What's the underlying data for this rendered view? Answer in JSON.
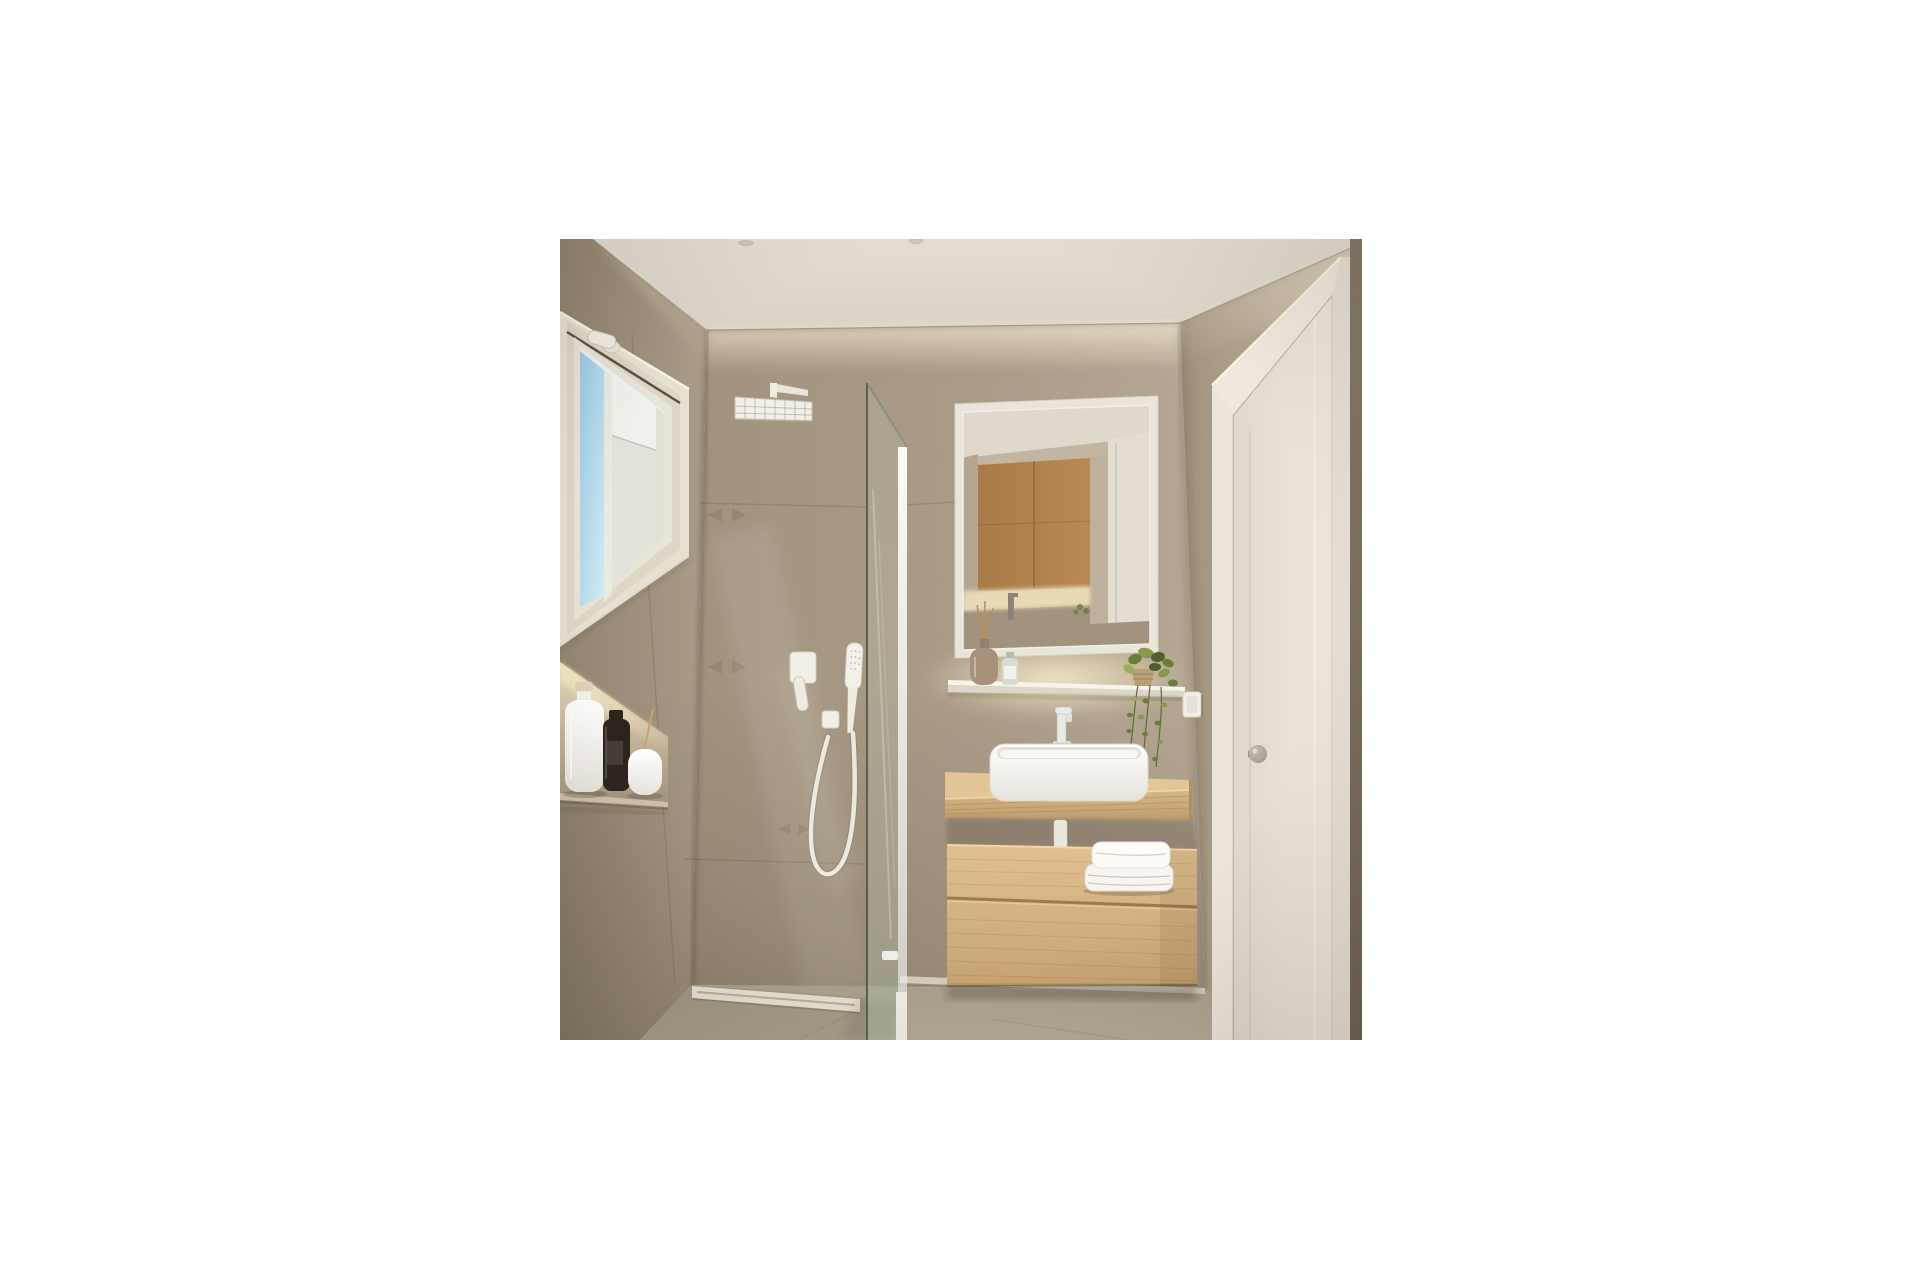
{
  "meta": {
    "description": "3D architectural render of a small modern bathroom with walk-in shower, floating oak vanity, backlit mirror and white interior door",
    "canvas": {
      "width": 1920,
      "height": 1280
    },
    "image_box": {
      "left": 560,
      "top": 239,
      "width": 802,
      "height": 801
    }
  },
  "palette": {
    "background": "#ffffff",
    "ceiling": "#d9d2c6",
    "wall_tile": "#ab9c87",
    "wall_tile_dark": "#8f816c",
    "wall_smooth": "#b9ab97",
    "floor": "#b6aa98",
    "wood": "#d7b786",
    "wood_dark": "#c09e6e",
    "mirror_wood": "#b98a55",
    "fixture_white": "#f3f0e8",
    "door_white": "#e7e1d6",
    "frame_white": "#eee8dd",
    "glass_tint": "#8fa896",
    "sky_blue": "#9ccbe4",
    "plant_green": "#6b7d3a",
    "towel_white": "#f7f5f0",
    "glow_warm": "#f5e7c2",
    "bottle_dark": "#2c241d",
    "knob_grey": "#999184",
    "drain_white": "#e7e2d5",
    "shadow_brown": "#5f5140"
  },
  "scene": {
    "objects": [
      {
        "name": "ceiling",
        "finish": "matte plaster",
        "spotlights": 2
      },
      {
        "name": "left-wall",
        "finish": "large-format textured stone tile"
      },
      {
        "name": "window",
        "frame": "white PVC with tilt handle",
        "view": "blue sky and white neighboring wall"
      },
      {
        "name": "wall-niche",
        "lighting": "warm LED strip",
        "items": [
          "white bottle with wooden cap",
          "dark bottle",
          "white dispenser with reed stick"
        ]
      },
      {
        "name": "rain-shower-head",
        "shape": "square, wall-mounted arm"
      },
      {
        "name": "shower-mixer-valve",
        "style": "square white plate with lever"
      },
      {
        "name": "hand-shower",
        "mount": "wall outlet with looping hose"
      },
      {
        "name": "glass-shower-screen",
        "type": "fixed walk-in panel, seen edge-on"
      },
      {
        "name": "mirror",
        "frame": "white",
        "reflection": [
          "oak wood panel",
          "white door",
          "backlit counter",
          "faucet"
        ]
      },
      {
        "name": "under-mirror-shelf",
        "lighting": "LED backlight",
        "items": [
          "reed diffuser bottle",
          "small bottle"
        ]
      },
      {
        "name": "hanging-plant",
        "pot": "rope basket",
        "foliage": "trailing ivy"
      },
      {
        "name": "light-switch",
        "style": "white rocker"
      },
      {
        "name": "floating-vanity",
        "parts": [
          "oak counter shelf",
          "white vessel sink",
          "tall white faucet",
          "oak drawer cabinet",
          "folded white towels"
        ]
      },
      {
        "name": "interior-door",
        "state": "closed",
        "knob": "round satin-nickel"
      },
      {
        "name": "shower-drain",
        "type": "linear, flush with floor"
      },
      {
        "name": "floor",
        "finish": "large-format grey-beige tile"
      }
    ]
  }
}
